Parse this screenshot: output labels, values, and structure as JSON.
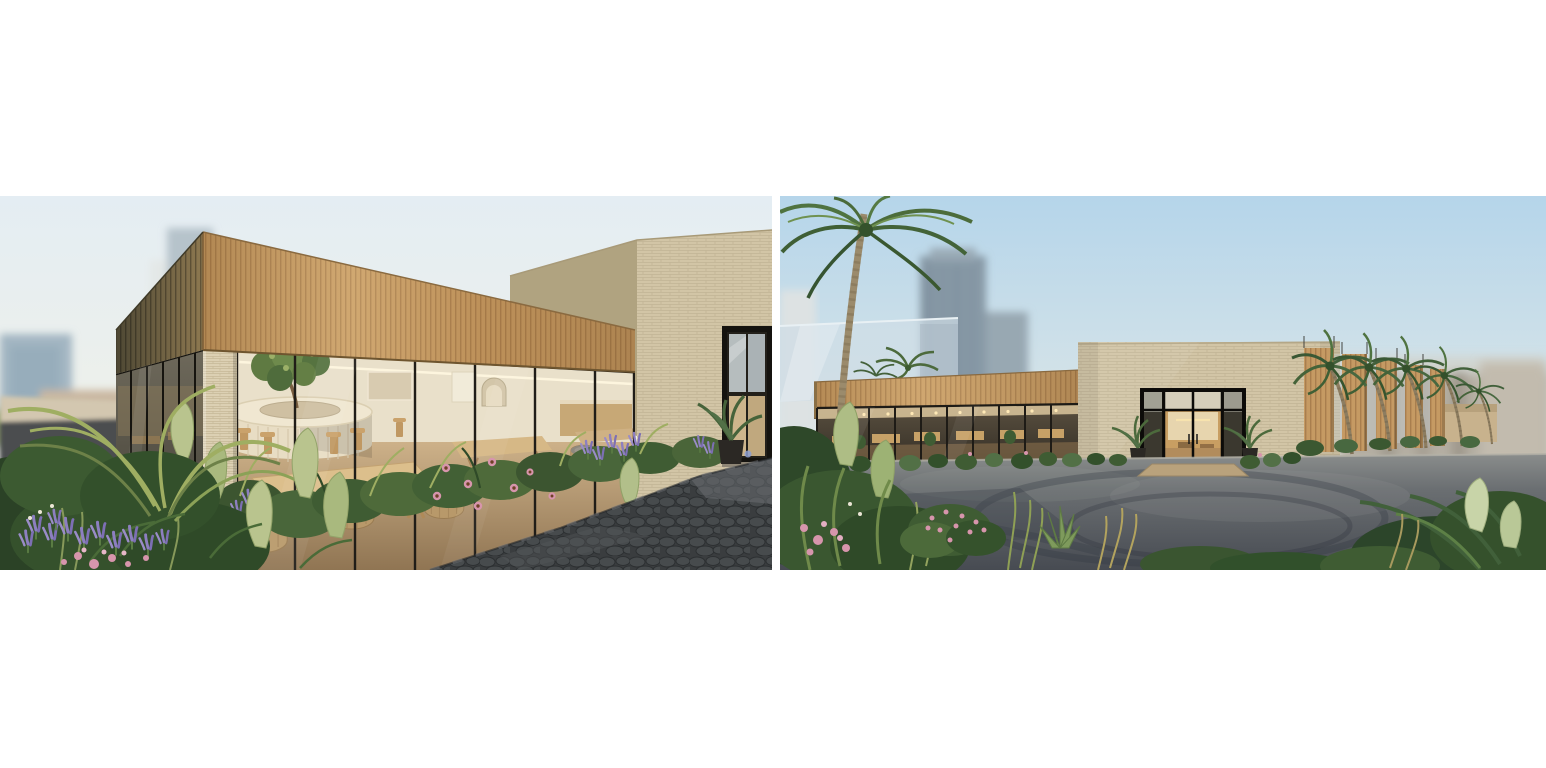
{
  "page": {
    "background_color": "#ffffff"
  },
  "gallery": {
    "images": [
      {
        "id": "cafe-terrace-corner-render",
        "alt": "Architectural rendering: corner view of a single-storey cafe with a deep timber-slat fascia, full-height glazing, a circular bar with a tree planted at its centre, timber communal tables and barrel chairs, lush planting of ferns, lavender and pink coneflowers in the foreground, a dark stone paved path at right, a beige brick volume with a black-framed glass door behind, and a blurred city skyline to the left."
      },
      {
        "id": "entrance-parking-lot-render",
        "alt": "Architectural rendering: wide view across an asphalt car park with tire marks toward the same cafe building — timber-slat fascia wing with glazed wall on the left, beige brick entry volume with black-framed glass doors and potted plants in the centre, a row of timber fins with leaning palm trees on the right, a tall palm at left, blurred high-rise towers and hazy low buildings behind, flowering shrubs, grasses and tropical foliage in the foreground."
      }
    ]
  },
  "palette": {
    "page_bg": "#ffffff",
    "sky_pale": "#e4edf3",
    "sky_blue": "#b5d5ea",
    "horizon_warm": "#f3efe4",
    "wood": "#c59a63",
    "wood_deep": "#a87e4e",
    "wood_shadow": "#57503a",
    "brick": "#d2c5a6",
    "brick_shade": "#b0a380",
    "column_brick": "#dcd0b3",
    "frame_black": "#201d18",
    "interior_cream": "#e9e0ca",
    "interior_wood": "#c9ad82",
    "glass_blue": "#cfdde6",
    "tower_grey": "#8799a6",
    "haze_grey": "#b4aea2",
    "asphalt_light": "#8a8d8c",
    "asphalt_dark": "#474b52",
    "stone_path": "#3a3d3f",
    "leaf_dark": "#33502b",
    "leaf_mid": "#5d7f45",
    "leaf_light": "#9fae62",
    "leaf_pale": "#b9c48e",
    "lavender": "#8d7fc0",
    "pink_flower": "#d795ac"
  }
}
